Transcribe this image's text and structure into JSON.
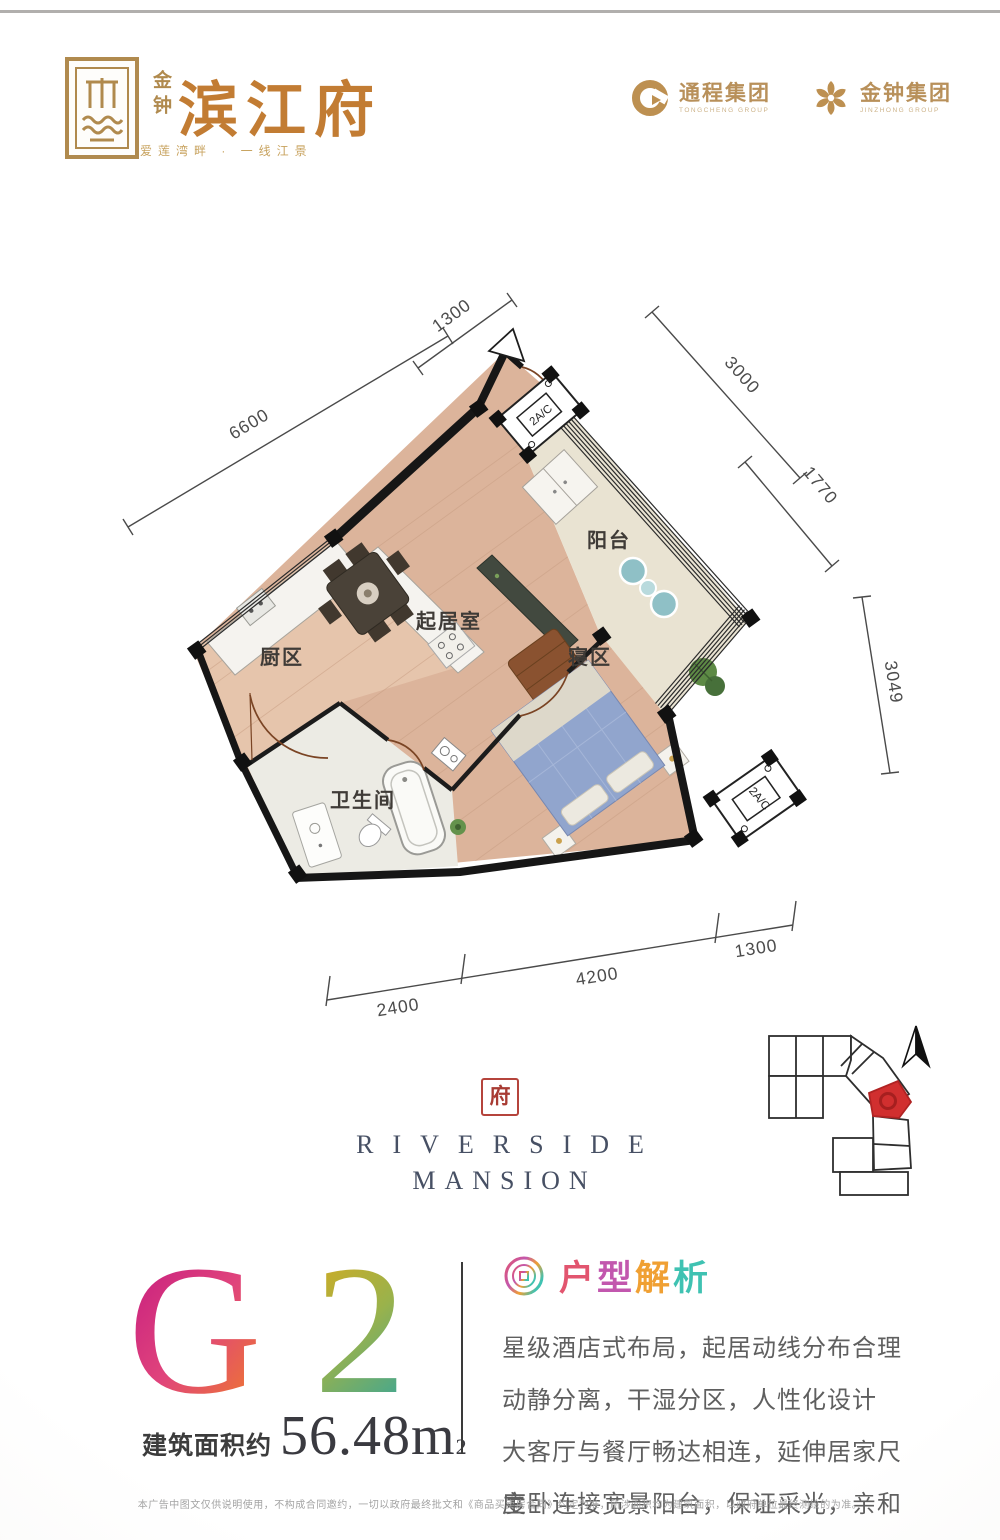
{
  "header": {
    "emblem_label": "金钟",
    "brand": "滨江府",
    "tagline": "爱莲湾畔 · 一线江景",
    "partners": [
      {
        "name": "通程集团",
        "subtitle": "TONGCHENG GROUP"
      },
      {
        "name": "金钟集团",
        "subtitle": "JINZHONG GROUP"
      }
    ]
  },
  "floorplan": {
    "rooms": [
      {
        "label": "阳台"
      },
      {
        "label": "起居室"
      },
      {
        "label": "厨区"
      },
      {
        "label": "寝区"
      },
      {
        "label": "卫生间"
      }
    ],
    "ac_units": [
      {
        "label": "2A/C"
      },
      {
        "label": "2A/C"
      }
    ],
    "dimensions": [
      {
        "value": "1300"
      },
      {
        "value": "3000"
      },
      {
        "value": "6600"
      },
      {
        "value": "1770"
      },
      {
        "value": "3049"
      },
      {
        "value": "2400"
      },
      {
        "value": "4200"
      },
      {
        "value": "1300"
      }
    ]
  },
  "brand_mark": {
    "seal": "府",
    "line1": "RIVERSIDE",
    "line2": "MANSION"
  },
  "unit_info": {
    "code_chars": [
      {
        "ch": "G"
      },
      {
        "ch": "2"
      }
    ],
    "area_label": "建筑面积约",
    "area_value": "56.48m",
    "area_sup": "2"
  },
  "analysis": {
    "title_chars": [
      {
        "ch": "户",
        "color": "#e2556f"
      },
      {
        "ch": "型",
        "color": "#c257ae"
      },
      {
        "ch": "解",
        "color": "#f0a033"
      },
      {
        "ch": "析",
        "color": "#3fc2b2"
      }
    ],
    "lines": [
      "星级酒店式布局，起居动线分布合理",
      "动静分离，干湿分区，人性化设计",
      "大客厅与餐厅畅达相连，延伸居家尺度",
      "主卧连接宽景阳台，保证采光，亲和自然"
    ]
  },
  "site_map": {
    "highlight_color": "#d12f2f"
  },
  "colors": {
    "brand_gold": "#b08a4e",
    "title_bronze": "#c27c33",
    "g_gradient": [
      "#c11580",
      "#ef7c28"
    ],
    "two_gradient": [
      "#dcaa1c",
      "#45a78e"
    ],
    "wall": "#1a1a1a",
    "wood_floor": "#dcb49b",
    "balcony_floor": "#e9e3d2",
    "seal_red": "#b5443c"
  },
  "disclaimer": "本广告中图文仅供说明使用，不构成合同邀约，一切以政府最终批文和《商品买卖房合同》约定为准，所涉面积均为建筑面积，以政府单位最终测绘的为准。"
}
